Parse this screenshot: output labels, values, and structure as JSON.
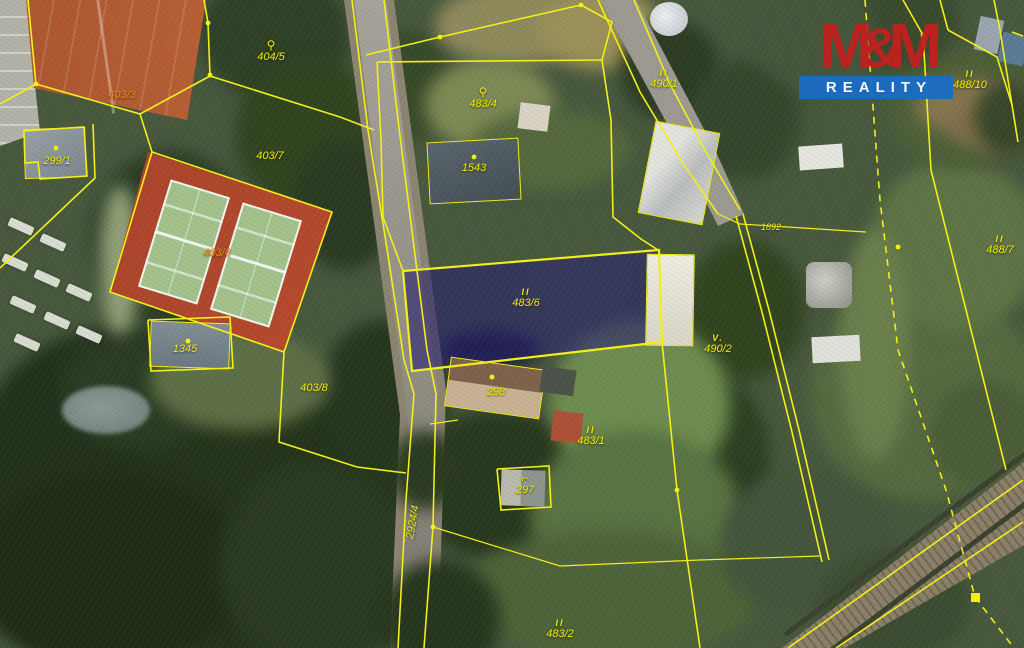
{
  "logo": {
    "m_left": "M",
    "amp": "&",
    "m_right": "M",
    "reality": "REALITY"
  },
  "colors": {
    "cadastral_line": "#f2ee1a",
    "parcel_label": "#ece80a",
    "parcel_label_alt": "#ef8a1c",
    "highlight_fill": "rgba(43,34,120,0.52)",
    "logo_red": "#c41f1f",
    "logo_blue": "#1a6cc5"
  },
  "icons": {
    "circle": "⚲",
    "hook": "⌐"
  },
  "parcels": {
    "highlighted": {
      "land_use_symbol": "II",
      "number": "483/6"
    },
    "labels": [
      {
        "number": "404/5",
        "icon": "circle",
        "x": 271,
        "y": 52
      },
      {
        "number": "403/3",
        "alt": true,
        "x": 122,
        "y": 95
      },
      {
        "number": "403/7",
        "x": 270,
        "y": 156
      },
      {
        "number": "299/1",
        "x": 57,
        "y": 161
      },
      {
        "number": "403/6",
        "alt": true,
        "x": 217,
        "y": 253
      },
      {
        "number": "1345",
        "x": 185,
        "y": 349
      },
      {
        "number": "403/8",
        "x": 314,
        "y": 388
      },
      {
        "number": "1543",
        "x": 474,
        "y": 168
      },
      {
        "number": "483/4",
        "icon": "circle",
        "x": 483,
        "y": 99
      },
      {
        "number": "483/6",
        "symbol": "II",
        "x": 526,
        "y": 298
      },
      {
        "number": "298",
        "x": 496,
        "y": 392
      },
      {
        "number": "483/1",
        "symbol": "II",
        "x": 591,
        "y": 436
      },
      {
        "number": "297",
        "icon": "hook",
        "x": 525,
        "y": 485
      },
      {
        "number": "2924/4",
        "rotate": -80,
        "x": 413,
        "y": 522
      },
      {
        "number": "490/1",
        "symbol": "II",
        "x": 664,
        "y": 79
      },
      {
        "number": "1892",
        "small": true,
        "x": 771,
        "y": 227
      },
      {
        "number": "490/2",
        "symbol": "V.",
        "x": 718,
        "y": 344
      },
      {
        "number": "488/10",
        "symbol": "II",
        "x": 970,
        "y": 80
      },
      {
        "number": "488/7",
        "symbol": "II",
        "x": 1000,
        "y": 245
      },
      {
        "number": "483/2",
        "symbol": "II",
        "x": 560,
        "y": 629
      }
    ]
  }
}
